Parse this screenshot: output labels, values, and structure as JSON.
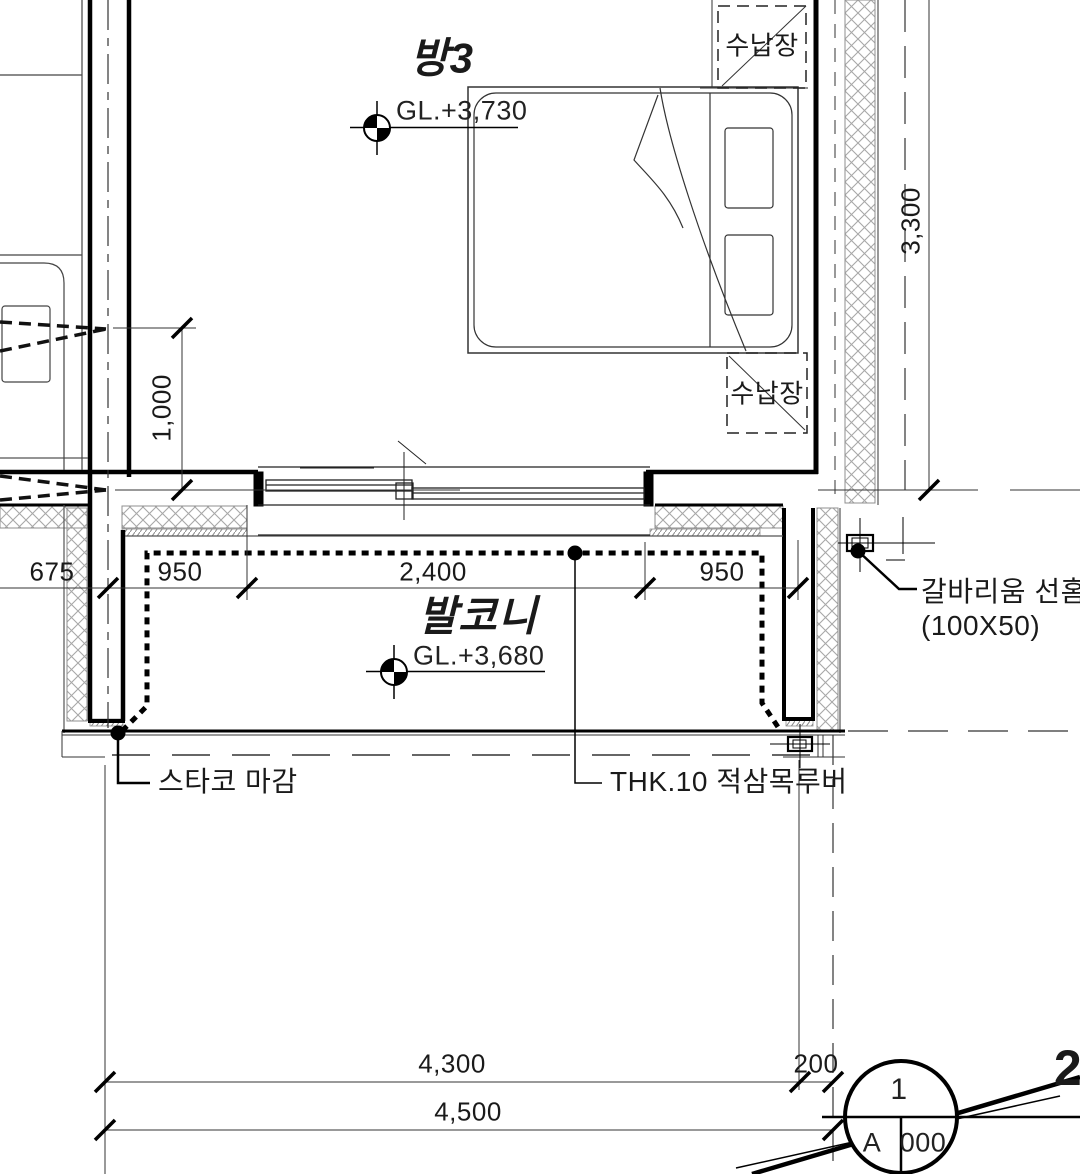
{
  "drawing": {
    "room3": {
      "title": "방3",
      "level": "GL.+3,730"
    },
    "balcony": {
      "title": "발코니",
      "level": "GL.+3,680"
    },
    "storage": {
      "top": "수납장",
      "middle": "수납장"
    },
    "notes": {
      "gutter": "갈바리움 선홈",
      "gutter_size": "(100X50)",
      "stucco": "스타코 마감",
      "louver": "THK.10 적삼목루버"
    },
    "dims": {
      "v_3300": "3,300",
      "v_1000": "1,000",
      "d_675": "675",
      "d_950l": "950",
      "d_2400": "2,400",
      "d_950r": "950",
      "edge_partial": "5",
      "b_4300": "4,300",
      "b_200": "200",
      "b_4500": "4,500"
    },
    "detail": {
      "top": "1",
      "sheet_left": "A",
      "sheet_right": "000"
    },
    "corner_number": "2",
    "colors": {
      "line": "#1a1a1a",
      "hatch": "#9a9a9a",
      "bg": "#ffffff"
    }
  }
}
